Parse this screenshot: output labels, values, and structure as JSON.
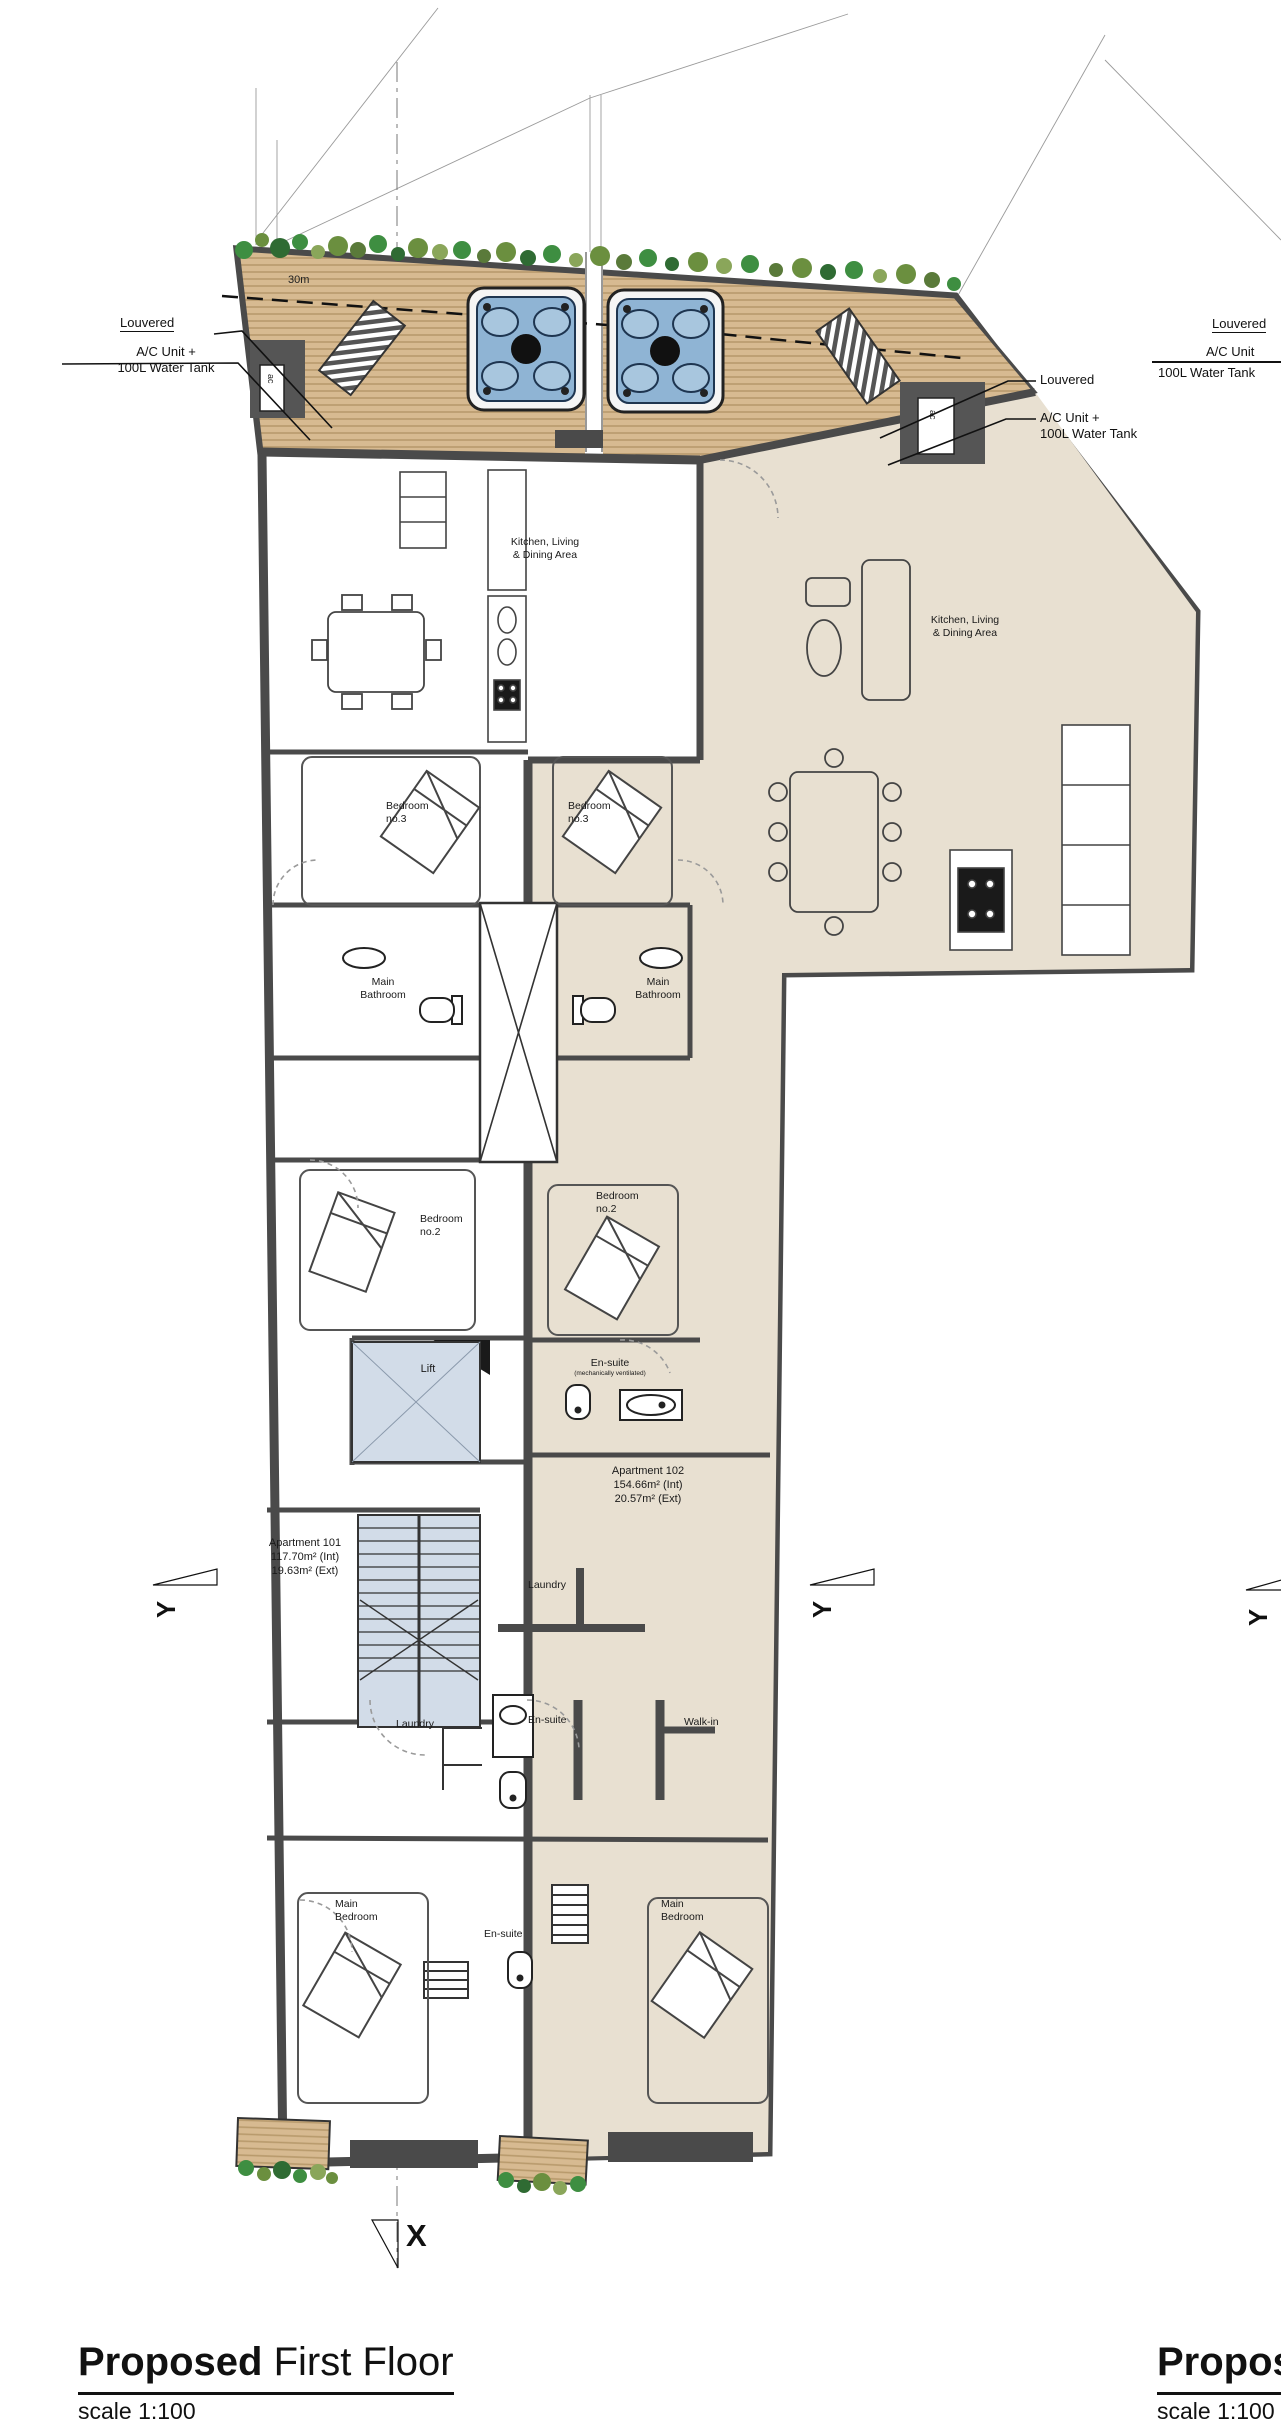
{
  "drawing": {
    "title": {
      "bold": "Proposed",
      "rest": " First Floor",
      "scale": "scale 1:100"
    },
    "adjacent": {
      "title_bold": "Proposed",
      "scale": "scale 1:100",
      "louvered": "Louvered",
      "ac_unit": "A/C Unit",
      "water_tank": "100L Water Tank"
    },
    "callouts": {
      "left": {
        "louvered": "Louvered",
        "ac1": "A/C Unit +",
        "ac2": "100L Water Tank"
      },
      "right": {
        "louvered": "Louvered",
        "ac1": "A/C Unit +",
        "ac2": "100L Water Tank"
      }
    },
    "deck": {
      "dimension": "30m",
      "ac_small": "ac"
    },
    "rooms": {
      "kitchen_1": "Kitchen, Living",
      "kitchen_2": "& Dining Area",
      "bedroom3_1": "Bedroom",
      "bedroom3_2": "no.3",
      "bath_1": "Main",
      "bath_2": "Bathroom",
      "bedroom2_1": "Bedroom",
      "bedroom2_2": "no.2",
      "lift": "Lift",
      "ensuite": "En-suite",
      "ensuite_note": "(mechanically ventilated)",
      "laundry": "Laundry",
      "walkin": "Walk-in",
      "mainbed_1": "Main",
      "mainbed_2": "Bedroom"
    },
    "apartments": {
      "a102": {
        "name": "Apartment 102",
        "int": "154.66m² (Int)",
        "ext": "20.57m² (Ext)"
      },
      "a101": {
        "name": "Apartment 101",
        "int": "117.70m² (Int)",
        "ext": "19.63m² (Ext)"
      }
    },
    "markers": {
      "x": "X",
      "y": "Y"
    }
  },
  "colors": {
    "wall": "#4a4a4a",
    "apartment_beige": "#e8e0d1",
    "stair_blue": "#d2dce8",
    "deck_wood": "#d7ba91",
    "deck_stripe": "#b89a6c",
    "hot_tub_blue": "#8fb4d4",
    "foliage_green": "#3e8e41"
  }
}
